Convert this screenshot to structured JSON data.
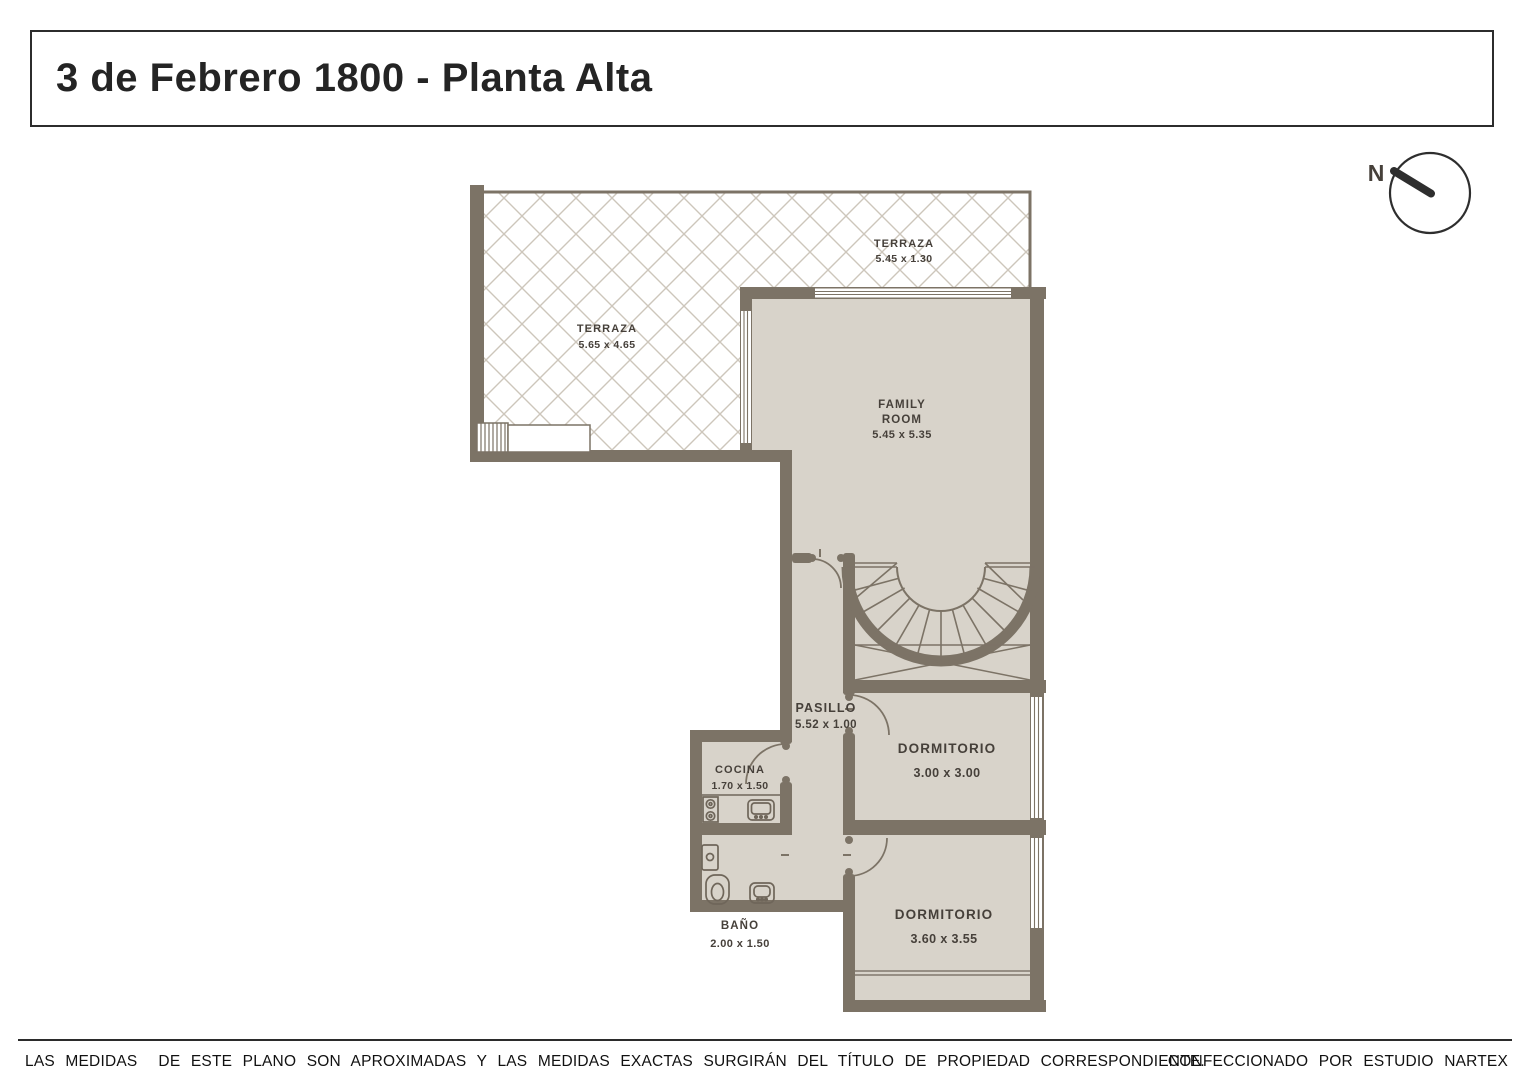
{
  "title": "3 de Febrero 1800 - Planta Alta",
  "compass": {
    "north_label": "N"
  },
  "rooms": {
    "terraza_top": {
      "name": "TERRAZA",
      "dims": "5.45 x 1.30"
    },
    "terraza_left": {
      "name": "TERRAZA",
      "dims": "5.65 x 4.65"
    },
    "family_room": {
      "name_line1": "FAMILY",
      "name_line2": "ROOM",
      "dims": "5.45 x 5.35"
    },
    "pasillo": {
      "name": "PASILLO",
      "dims": "5.52 x 1.00"
    },
    "cocina": {
      "name": "COCINA",
      "dims": "1.70 x 1.50"
    },
    "dormitorio_1": {
      "name": "DORMITORIO",
      "dims": "3.00 x 3.00"
    },
    "bano": {
      "name": "BAÑO",
      "dims": "2.00 x 1.50"
    },
    "dormitorio_2": {
      "name": "DORMITORIO",
      "dims": "3.60 x 3.55"
    }
  },
  "footer": {
    "disclaimer": "LAS MEDIDAS  DE ESTE PLANO SON APROXIMADAS Y LAS MEDIDAS EXACTAS SURGIRÁN DEL TÍTULO DE PROPIEDAD CORRESPONDIENTE.",
    "credit": "CONFECCIONADO POR ESTUDIO NARTEX"
  },
  "colors": {
    "wall": "#7c7366",
    "floor": "#d8d3ca",
    "hatch_line": "#cdc6bb",
    "ink": "#2c2c2c"
  }
}
